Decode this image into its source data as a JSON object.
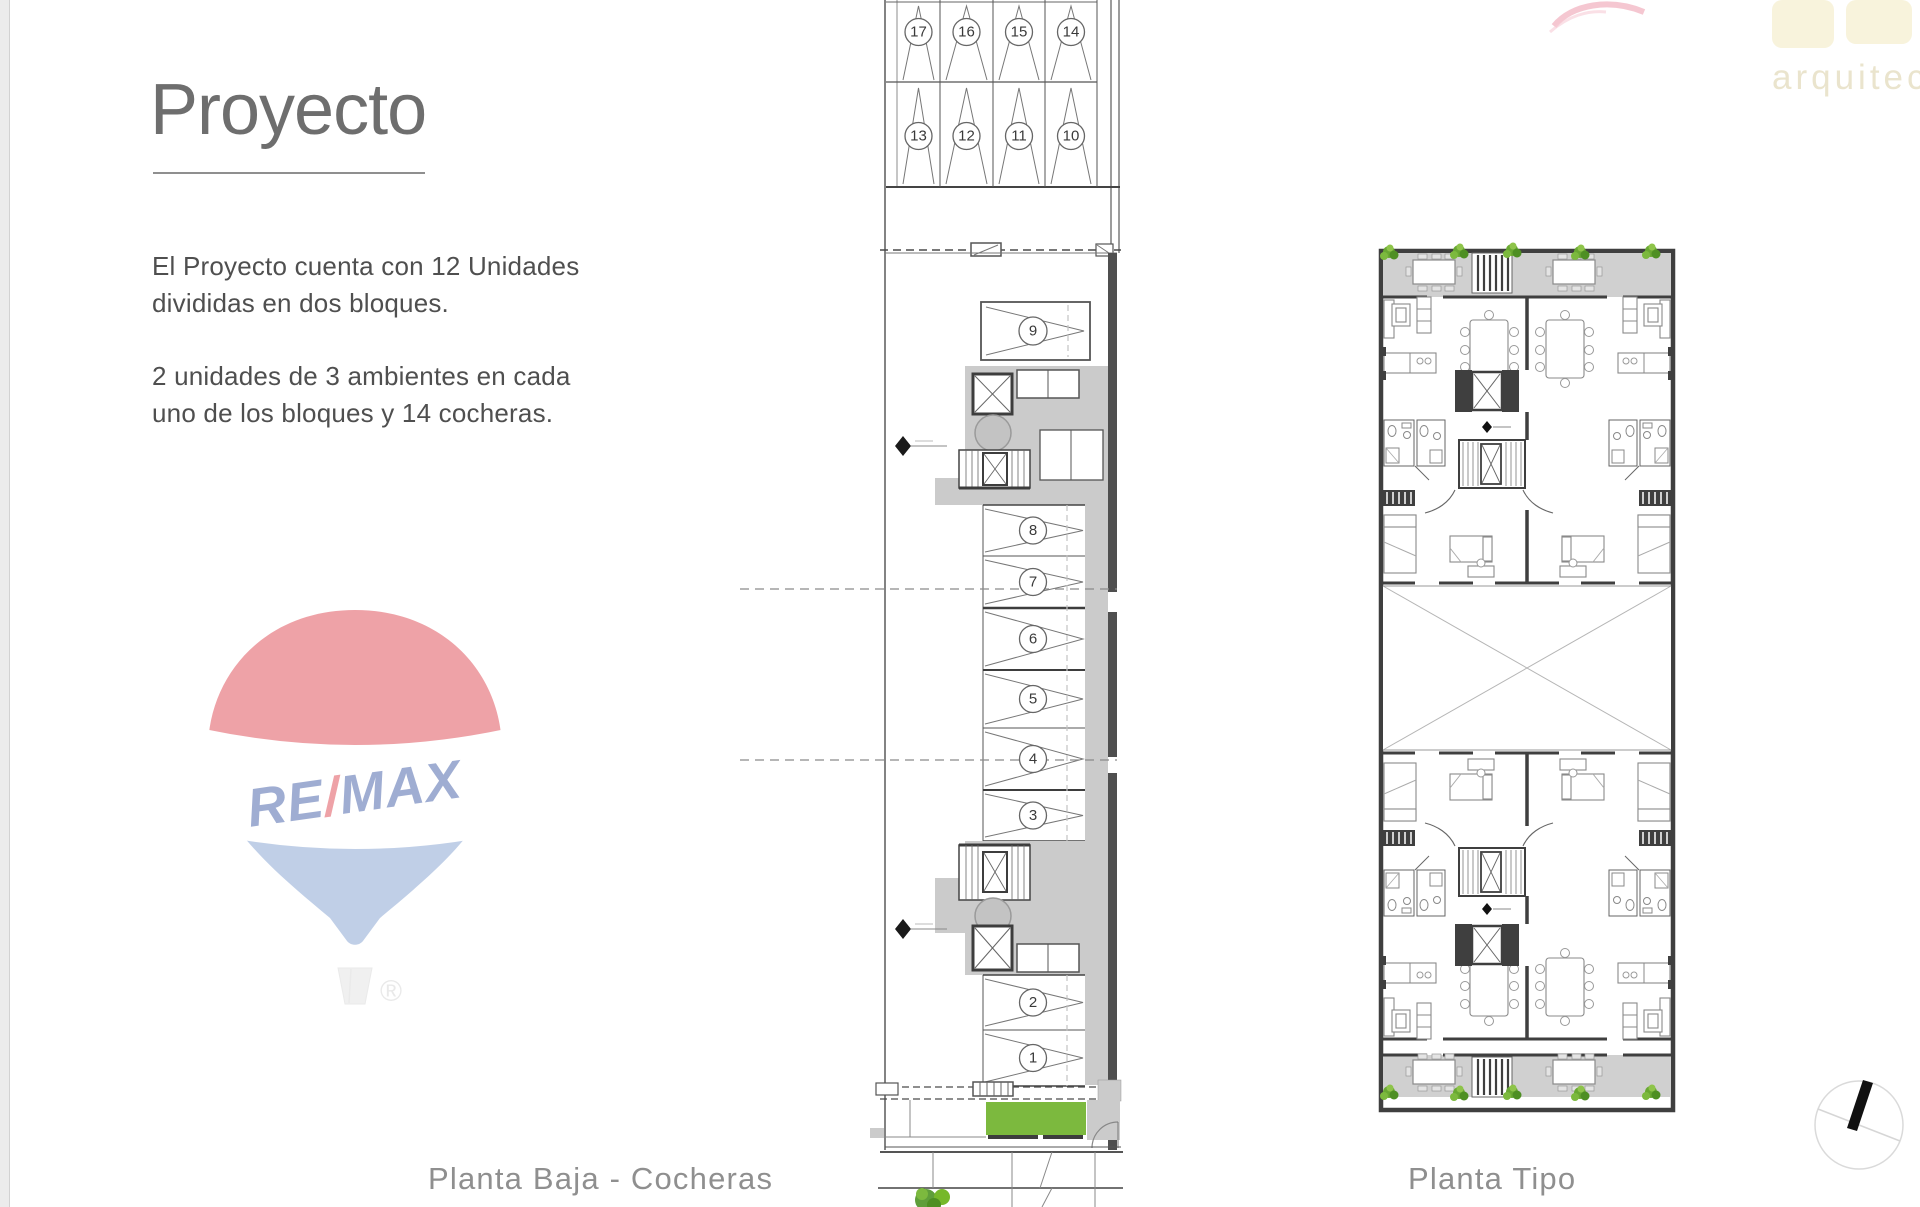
{
  "left_panel": {
    "title": "Proyecto",
    "paragraph1": "El Proyecto cuenta con 12 Unidades\ndivididas en dos bloques.",
    "paragraph2": "2 unidades de 3 ambientes en cada\nuno de los bloques y 14 cocheras."
  },
  "remax_logo": {
    "part1": "RE",
    "slash": "/",
    "part2": "MAX",
    "registered_mark": "®"
  },
  "architect_watermark": {
    "text": "arquitec"
  },
  "floor_plans": {
    "cocheras": {
      "label": "Planta Baja - Cocheras",
      "row1_spots": [
        "17",
        "16",
        "15",
        "14"
      ],
      "row2_spots": [
        "13",
        "12",
        "11",
        "10"
      ],
      "column_spots": [
        "9",
        "8",
        "7",
        "6",
        "5",
        "4",
        "3",
        "2",
        "1"
      ]
    },
    "tipo": {
      "label": "Planta Tipo"
    }
  },
  "colors": {
    "accent_green": "#7cb93e",
    "plan_gray": "#cbcbcb",
    "terrace_gray": "#d0d0d0",
    "wall_dark": "#3f3f3f",
    "remax_red": "#d8232f",
    "remax_blue": "#1d3e96",
    "remax_light_blue": "#6c8fc8"
  }
}
